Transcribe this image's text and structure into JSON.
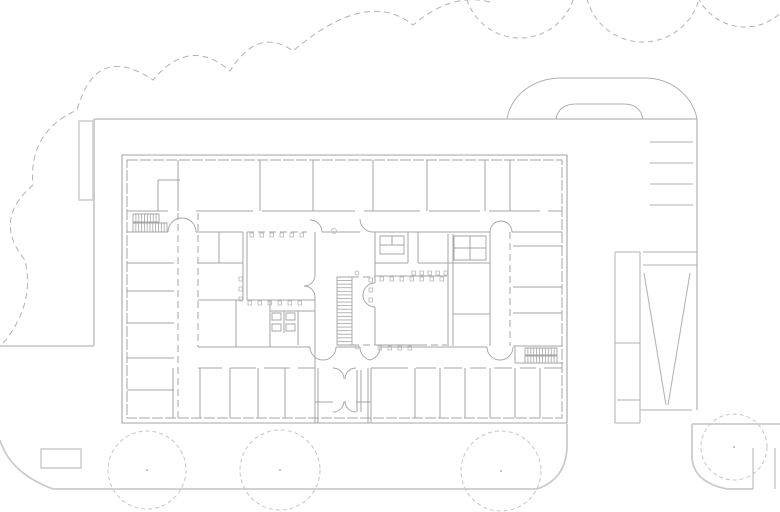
{
  "drawing": {
    "kind": "architectural-floor-plan",
    "canvas": {
      "w": 780,
      "h": 512,
      "background": "#ffffff"
    },
    "colors": {
      "wall": "#a4a4a6",
      "wall_light": "#b6b6b8",
      "site_heavy": "#cbcbcd",
      "site_thin": "#b0b0b2",
      "tree_canopy": "#b2b2b4",
      "tree_circle": "#c6c6c8",
      "tree_dot": "#b2b2b4"
    },
    "trees": {
      "canopy_path": "M490,2Q452,-8 413,25Q367,-12 293,51Q258,26 230,71Q190,36 153,80Q96,42 77,110Q28,132 33,185Q-8,220 25,260Q36,306 0,347",
      "top_circles": [
        [
          520,
          -18,
          56
        ],
        [
          643,
          -16,
          58
        ],
        [
          745,
          -25,
          52
        ]
      ],
      "ground_circles": [
        [
          147,
          470,
          39
        ],
        [
          280,
          470,
          40
        ],
        [
          501,
          471,
          40
        ],
        [
          734,
          447,
          33
        ]
      ]
    },
    "site": {
      "heavy_lines": [
        [
          94,
          119,
          697,
          119
        ],
        [
          94,
          119,
          94,
          346
        ],
        [
          0,
          346,
          94,
          346
        ],
        [
          697,
          119,
          697,
          410
        ],
        [
          53,
          489,
          537,
          489
        ],
        [
          692,
          424,
          780,
          424
        ],
        [
          567,
          424,
          567,
          447
        ]
      ],
      "heavy_paths": [
        "M0,440Q10,473 53,489",
        "M567,447Q566,479 537,489",
        "M692,424L692,457Q693,482 727,489L753,489"
      ],
      "heavy_rects": [
        [
          79,
          121,
          14,
          79
        ],
        [
          41,
          449,
          40,
          19
        ]
      ],
      "thin_lines": [
        [
          650,
          142,
          693,
          142
        ],
        [
          650,
          163,
          693,
          163
        ],
        [
          650,
          184,
          693,
          184
        ],
        [
          650,
          205,
          693,
          205
        ],
        [
          615,
          252,
          615,
          423
        ],
        [
          640,
          252,
          640,
          423
        ],
        [
          615,
          252,
          640,
          252
        ],
        [
          615,
          343,
          640,
          343
        ],
        [
          617,
          400,
          640,
          400
        ],
        [
          615,
          423,
          640,
          423
        ],
        [
          643,
          252,
          697,
          252
        ],
        [
          643,
          265,
          697,
          265
        ],
        [
          640,
          410,
          692,
          410
        ],
        [
          644,
          273,
          666,
          405
        ],
        [
          690,
          273,
          668,
          405
        ],
        [
          753,
          448,
          753,
          489
        ],
        [
          775,
          448,
          775,
          489
        ]
      ],
      "thin_paths": [
        "M507,119C511,96 532,78 562,78L645,78C672,78 693,97 697,119",
        "M556,119C558,108 566,104 576,104L624,104C635,104 641,109 643,119"
      ]
    },
    "building": {
      "outer_rect": [
        122,
        155,
        445,
        268
      ],
      "inner_rect": [
        127,
        160,
        435,
        258
      ],
      "walls": [
        [
          178,
          160,
          178,
          211
        ],
        [
          260,
          160,
          260,
          211
        ],
        [
          313,
          160,
          313,
          211
        ],
        [
          373,
          160,
          373,
          211
        ],
        [
          427,
          160,
          427,
          211
        ],
        [
          485,
          160,
          485,
          211
        ],
        [
          510,
          160,
          510,
          211
        ],
        [
          158,
          180,
          158,
          211
        ],
        [
          158,
          180,
          180,
          180
        ],
        [
          127,
          211,
          168,
          211
        ],
        [
          196,
          211,
          253,
          211
        ],
        [
          262,
          211,
          355,
          211
        ],
        [
          364,
          211,
          420,
          211
        ],
        [
          429,
          211,
          480,
          211
        ],
        [
          489,
          211,
          540,
          211
        ],
        [
          548,
          211,
          562,
          211
        ],
        [
          127,
          232,
          168,
          232
        ],
        [
          196,
          232,
          243,
          232
        ],
        [
          322,
          232,
          360,
          232
        ],
        [
          373,
          232,
          490,
          232
        ],
        [
          512,
          232,
          562,
          232
        ],
        [
          127,
          263,
          174,
          263
        ],
        [
          127,
          291,
          174,
          291
        ],
        [
          127,
          323,
          174,
          323
        ],
        [
          127,
          358,
          174,
          358
        ],
        [
          127,
          390,
          174,
          390
        ],
        [
          243,
          232,
          243,
          300
        ],
        [
          247,
          232,
          247,
          300
        ],
        [
          315,
          232,
          315,
          275
        ],
        [
          315,
          297,
          315,
          368
        ],
        [
          247,
          300,
          315,
          300
        ],
        [
          198,
          263,
          243,
          263
        ],
        [
          198,
          300,
          243,
          300
        ],
        [
          219,
          232,
          219,
          263
        ],
        [
          236,
          300,
          236,
          347
        ],
        [
          270,
          300,
          270,
          347
        ],
        [
          270,
          311,
          315,
          311
        ],
        [
          284,
          311,
          284,
          333
        ],
        [
          298,
          311,
          298,
          345
        ],
        [
          375,
          263,
          408,
          263
        ],
        [
          418,
          263,
          490,
          263
        ],
        [
          408,
          232,
          408,
          263
        ],
        [
          418,
          232,
          418,
          263
        ],
        [
          375,
          232,
          375,
          283
        ],
        [
          375,
          307,
          375,
          345
        ],
        [
          375,
          276,
          447,
          276
        ],
        [
          375,
          345,
          420,
          345
        ],
        [
          448,
          234,
          448,
          346
        ],
        [
          453,
          234,
          453,
          346
        ],
        [
          453,
          314,
          490,
          314
        ],
        [
          490,
          232,
          490,
          346
        ],
        [
          513,
          246,
          562,
          246
        ],
        [
          513,
          287,
          562,
          287
        ],
        [
          513,
          313,
          562,
          313
        ],
        [
          513,
          346,
          562,
          346
        ],
        [
          198,
          347,
          310,
          347
        ],
        [
          336,
          347,
          360,
          347
        ],
        [
          380,
          347,
          487,
          347
        ],
        [
          515,
          347,
          515,
          363
        ],
        [
          515,
          363,
          563,
          363
        ],
        [
          198,
          368,
          222,
          368
        ],
        [
          230,
          368,
          256,
          368
        ],
        [
          264,
          368,
          290,
          368
        ],
        [
          298,
          368,
          315,
          368
        ],
        [
          371,
          368,
          408,
          368
        ],
        [
          416,
          368,
          436,
          368
        ],
        [
          444,
          368,
          462,
          368
        ],
        [
          470,
          368,
          486,
          368
        ],
        [
          494,
          368,
          512,
          368
        ],
        [
          520,
          368,
          536,
          368
        ],
        [
          544,
          368,
          562,
          368
        ],
        [
          173,
          368,
          173,
          418
        ],
        [
          200,
          368,
          200,
          418
        ],
        [
          230,
          368,
          230,
          418
        ],
        [
          258,
          368,
          258,
          418
        ],
        [
          285,
          368,
          285,
          418
        ],
        [
          415,
          368,
          415,
          418
        ],
        [
          440,
          368,
          440,
          418
        ],
        [
          465,
          368,
          465,
          418
        ],
        [
          490,
          368,
          490,
          418
        ],
        [
          515,
          368,
          515,
          418
        ],
        [
          540,
          368,
          540,
          418
        ],
        [
          315,
          368,
          315,
          423
        ],
        [
          318,
          368,
          318,
          423
        ],
        [
          368,
          368,
          368,
          423
        ],
        [
          371,
          368,
          371,
          423
        ],
        [
          357,
          370,
          357,
          412
        ],
        [
          361,
          370,
          361,
          412
        ],
        [
          315,
          402,
          333,
          402
        ],
        [
          356,
          402,
          371,
          402
        ],
        [
          380,
          245,
          404,
          245
        ],
        [
          392,
          236,
          392,
          245
        ],
        [
          470,
          236,
          470,
          260
        ],
        [
          454,
          248,
          486,
          248
        ]
      ],
      "dashed_walls": [
        [
          178,
          213,
          178,
          418
        ],
        [
          198,
          213,
          198,
          347
        ],
        [
          247,
          232,
          307,
          232
        ],
        [
          420,
          345,
          447,
          345
        ],
        [
          352,
          277,
          375,
          277
        ],
        [
          352,
          345,
          375,
          345
        ],
        [
          320,
          423,
          368,
          423
        ],
        [
          510,
          232,
          510,
          346
        ]
      ],
      "doors": [
        "M168,232A14,14 0 0 1 182,218M196,232A14,14 0 0 0 182,218",
        "M490,232A11,11 0 0 1 501,221M512,232A11,11 0 0 0 501,221",
        "M310,347A13,13 0 0 0 323,360M336,347A13,13 0 0 1 323,360",
        "M360,347A13,13 0 0 0 370,360M380,347A13,13 0 0 1 370,360",
        "M487,347A13,13 0 0 0 500,360M513,347A13,13 0 0 1 500,360",
        "M375,283A12,12 0 0 0 363,295M375,307A12,12 0 0 1 363,295",
        "M315,275A11,11 0 0 1 304,286M315,297A11,11 0 0 0 304,286",
        "M322,232A12,12 0 0 0 310,220",
        "M373,232A13,13 0 0 1 360,219",
        "M333,368A11,11 0 0 1 344,379M356,368A11,11 0 0 0 345,379",
        "M333,412A11,11 0 0 0 344,401M356,412A11,11 0 0 1 345,401"
      ],
      "stairs": [
        {
          "x": 133,
          "y": 214,
          "w": 26,
          "h": 8,
          "dir": "h",
          "n": 9
        },
        {
          "x": 133,
          "y": 223,
          "w": 34,
          "h": 9,
          "dir": "h",
          "n": 12
        },
        {
          "x": 337,
          "y": 277,
          "w": 15,
          "h": 68,
          "dir": "v",
          "n": 19
        },
        {
          "x": 525,
          "y": 348,
          "w": 32,
          "h": 7,
          "dir": "h",
          "n": 11
        },
        {
          "x": 525,
          "y": 356,
          "w": 32,
          "h": 7,
          "dir": "h",
          "n": 11
        }
      ],
      "fixture_rects": [
        [
          272,
          313,
          9,
          7
        ],
        [
          272,
          324,
          9,
          7
        ],
        [
          286,
          313,
          9,
          7
        ],
        [
          286,
          324,
          9,
          7
        ],
        [
          380,
          236,
          24,
          18
        ],
        [
          454,
          236,
          32,
          24
        ]
      ],
      "mullion_ticks": [
        [
          250,
          233
        ],
        [
          260,
          233
        ],
        [
          270,
          233
        ],
        [
          280,
          233
        ],
        [
          290,
          233
        ],
        [
          300,
          233
        ],
        [
          248,
          301
        ],
        [
          258,
          301
        ],
        [
          268,
          301
        ],
        [
          278,
          301
        ],
        [
          288,
          301
        ],
        [
          298,
          301
        ],
        [
          239,
          277
        ],
        [
          239,
          287
        ],
        [
          239,
          297
        ],
        [
          380,
          277
        ],
        [
          390,
          277
        ],
        [
          400,
          277
        ],
        [
          410,
          277
        ],
        [
          420,
          277
        ],
        [
          430,
          277
        ],
        [
          440,
          277
        ],
        [
          378,
          346
        ],
        [
          388,
          346
        ],
        [
          398,
          346
        ],
        [
          408,
          346
        ],
        [
          369,
          278
        ],
        [
          369,
          288
        ],
        [
          369,
          298
        ],
        [
          412,
          271
        ],
        [
          420,
          271
        ],
        [
          428,
          271
        ],
        [
          436,
          271
        ],
        [
          444,
          271
        ]
      ],
      "small_circles": [
        [
          334,
          231,
          2.5
        ],
        [
          357,
          273,
          2
        ],
        [
          357,
          347,
          2
        ]
      ]
    }
  }
}
